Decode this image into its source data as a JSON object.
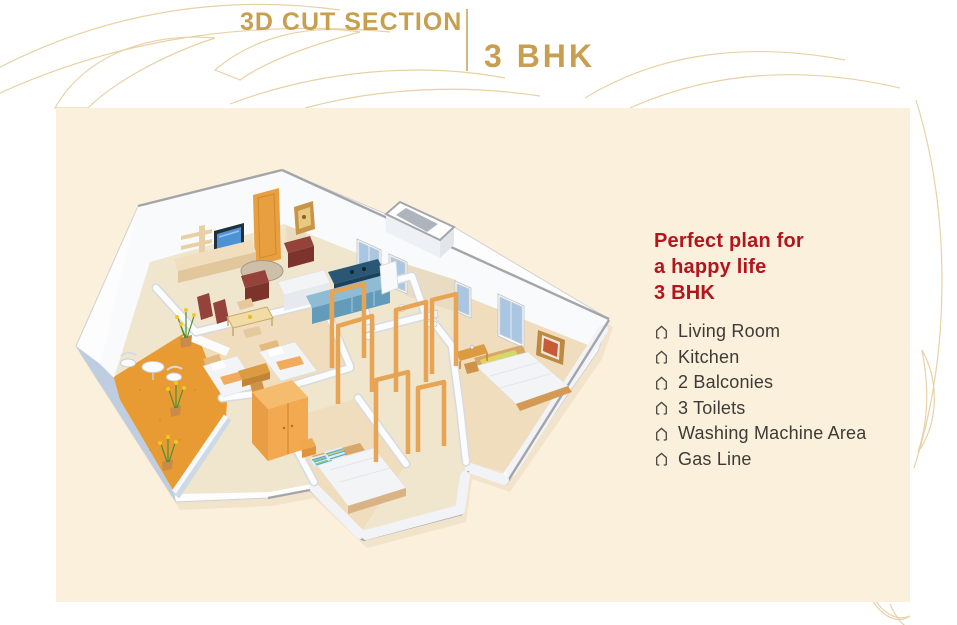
{
  "header": {
    "title": "3D CUT SECTION",
    "subtitle": "3 BHK"
  },
  "panel": {
    "heading": [
      "Perfect plan for",
      "a happy life",
      "3 BHK"
    ],
    "features": [
      "Living Room",
      "Kitchen",
      "2 Balconies",
      "3 Toilets",
      "Washing Machine Area",
      "Gas Line"
    ]
  },
  "palette": {
    "gold": "#C79F4F",
    "gold-light": "#E5CD9D",
    "cream": "#FBF0DC",
    "red": "#B2161D",
    "text-dark": "#3E3A36",
    "icon-dark": "#4A4540",
    "balcony-orange": "#E89B33",
    "wood": "#E8A455",
    "wall-white": "#F8FAFC",
    "window-blue": "#A9C6E2",
    "kitchen-blue": "#2A5874",
    "sofa-maroon": "#94423A",
    "floor-beige": "#F0E5CD",
    "floor-wood": "#EFDDBD",
    "slab-blue": "#BECDE0"
  }
}
